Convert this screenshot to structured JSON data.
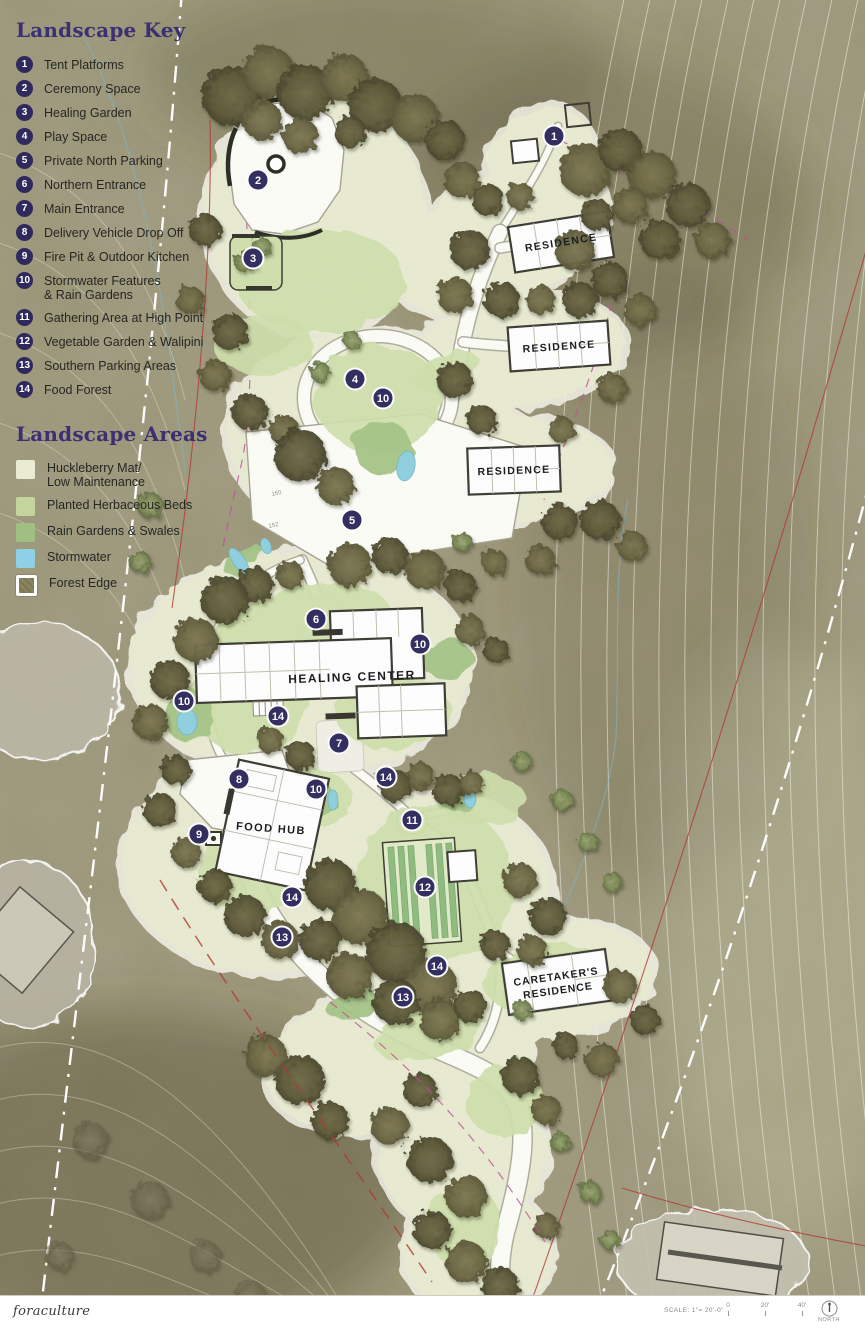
{
  "legend": {
    "key_title": "Landscape Key",
    "items": [
      {
        "num": "1",
        "label": "Tent Platforms"
      },
      {
        "num": "2",
        "label": "Ceremony Space"
      },
      {
        "num": "3",
        "label": "Healing Garden"
      },
      {
        "num": "4",
        "label": "Play Space"
      },
      {
        "num": "5",
        "label": "Private North Parking"
      },
      {
        "num": "6",
        "label": "Northern Entrance"
      },
      {
        "num": "7",
        "label": "Main Entrance"
      },
      {
        "num": "8",
        "label": "Delivery Vehicle Drop Off"
      },
      {
        "num": "9",
        "label": "Fire Pit & Outdoor Kitchen"
      },
      {
        "num": "10",
        "label": "Stormwater Features\n& Rain Gardens"
      },
      {
        "num": "11",
        "label": "Gathering Area at High Point"
      },
      {
        "num": "12",
        "label": "Vegetable Garden & Walipini"
      },
      {
        "num": "13",
        "label": "Southern Parking Areas"
      },
      {
        "num": "14",
        "label": "Food Forest"
      }
    ],
    "areas_title": "Landscape Areas",
    "areas": [
      {
        "label": "Huckleberry Mat/\nLow Maintenance",
        "color": "#e9ecd3",
        "style": "plain"
      },
      {
        "label": "Planted Herbaceous Beds",
        "color": "#c3d59d",
        "style": "plain"
      },
      {
        "label": "Rain Gardens & Swales",
        "color": "#9fc081",
        "style": "plain"
      },
      {
        "label": "Stormwater",
        "color": "#8ed1e6",
        "style": "plain"
      },
      {
        "label": "Forest Edge",
        "color": "#8a8560",
        "style": "forest-edge"
      }
    ]
  },
  "map": {
    "buildings": {
      "residence_north": "RESIDENCE",
      "residence_mid": "RESIDENCE",
      "residence_east": "RESIDENCE",
      "healing_center": "HEALING CENTER",
      "food_hub": "FOOD HUB",
      "caretakers_line1": "CARETAKER'S",
      "caretakers_line2": "RESIDENCE"
    },
    "markers": [
      {
        "n": "1",
        "x": 554,
        "y": 136
      },
      {
        "n": "2",
        "x": 258,
        "y": 180
      },
      {
        "n": "3",
        "x": 253,
        "y": 258
      },
      {
        "n": "4",
        "x": 355,
        "y": 379
      },
      {
        "n": "10",
        "x": 383,
        "y": 398
      },
      {
        "n": "5",
        "x": 352,
        "y": 520
      },
      {
        "n": "6",
        "x": 316,
        "y": 619
      },
      {
        "n": "10",
        "x": 420,
        "y": 644
      },
      {
        "n": "10",
        "x": 184,
        "y": 701
      },
      {
        "n": "14",
        "x": 278,
        "y": 716
      },
      {
        "n": "7",
        "x": 339,
        "y": 743
      },
      {
        "n": "8",
        "x": 239,
        "y": 779
      },
      {
        "n": "14",
        "x": 386,
        "y": 777
      },
      {
        "n": "10",
        "x": 316,
        "y": 789
      },
      {
        "n": "11",
        "x": 412,
        "y": 820
      },
      {
        "n": "9",
        "x": 199,
        "y": 834
      },
      {
        "n": "12",
        "x": 425,
        "y": 887
      },
      {
        "n": "14",
        "x": 292,
        "y": 897
      },
      {
        "n": "13",
        "x": 282,
        "y": 937
      },
      {
        "n": "14",
        "x": 437,
        "y": 966
      },
      {
        "n": "13",
        "x": 403,
        "y": 997
      }
    ],
    "contour_labels": [
      {
        "text": "150",
        "x": 272,
        "y": 496
      },
      {
        "text": "152",
        "x": 269,
        "y": 528
      }
    ]
  },
  "footer": {
    "brand": "foraculture",
    "scale_text": "SCALE: 1\"= 20'-0\"",
    "scale_ticks": [
      "0",
      "20'",
      "40'"
    ],
    "north_label": "NORTH"
  },
  "colors": {
    "terrain": "#a19c80",
    "marker": "#2e2a5d",
    "legend_title": "#3c2f73",
    "road": "#fdfdf8",
    "property_line_red": "#b23530",
    "easement_pink": "#c2489a"
  }
}
